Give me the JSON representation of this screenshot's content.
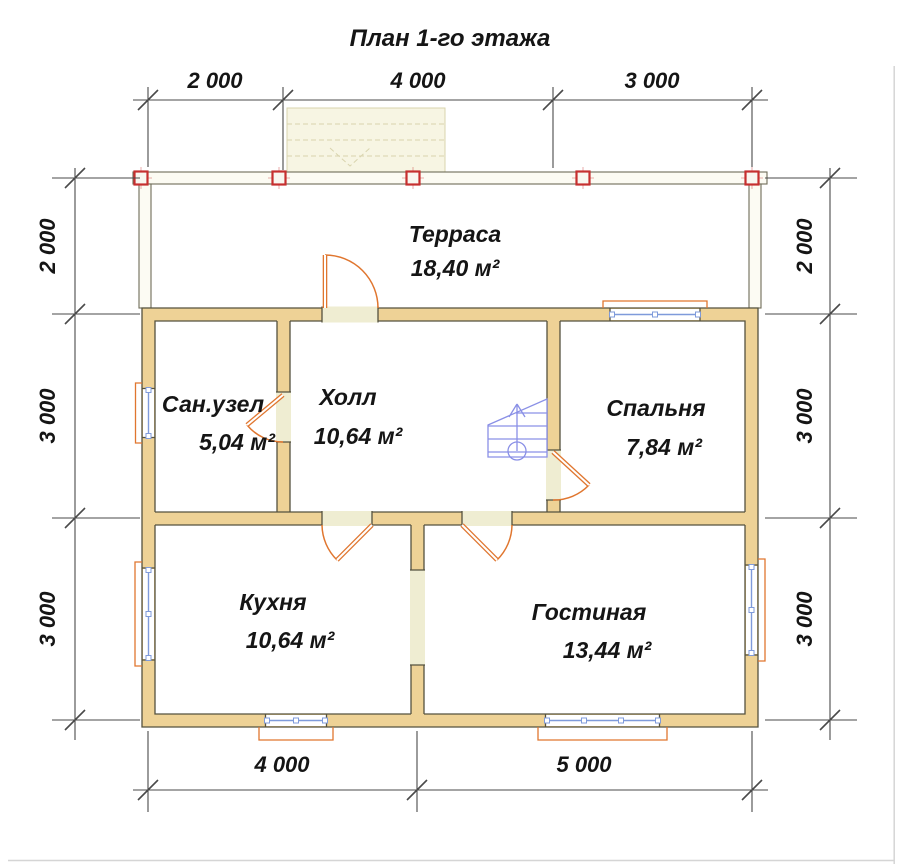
{
  "title": "План 1-го этажа",
  "dims": {
    "top": [
      "2 000",
      "4 000",
      "3 000"
    ],
    "bottom": [
      "4 000",
      "5 000"
    ],
    "left": [
      "2 000",
      "3 000",
      "3 000"
    ],
    "right": [
      "2 000",
      "3 000",
      "3 000"
    ]
  },
  "rooms": {
    "terrace": {
      "name": "Терраса",
      "area": "18,40 м²"
    },
    "bathroom": {
      "name": "Сан.узел",
      "area": "5,04 м²"
    },
    "hall": {
      "name": "Холл",
      "area": "10,64 м²"
    },
    "bedroom": {
      "name": "Спальня",
      "area": "7,84 м²"
    },
    "kitchen": {
      "name": "Кухня",
      "area": "10,64 м²"
    },
    "living": {
      "name": "Гостиная",
      "area": "13,44 м²"
    }
  },
  "colors": {
    "wall-fill": "#eed296",
    "wall-line": "#55523f",
    "opening": "#efedd2",
    "door": "#e0762f",
    "window": "#7f9bdb",
    "stairs": "#8a90e6",
    "post": "#c62f2f",
    "dim": "#4a4a4a",
    "text": "#151515",
    "thin-wall": "#6e6c58",
    "steps-fill": "#f7f5e3",
    "steps-line": "#d9d4ae",
    "edge": "#d5d5d5"
  }
}
